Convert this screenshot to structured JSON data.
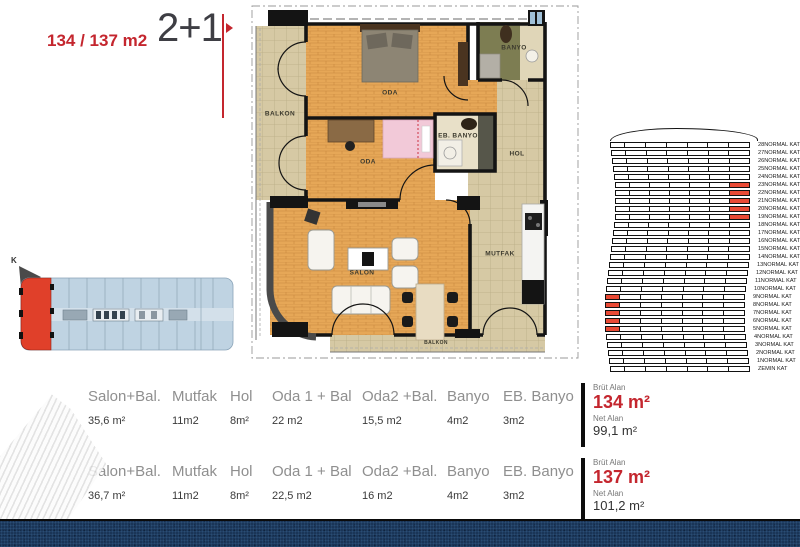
{
  "title": {
    "area_label": "134 / 137 m2",
    "type_label": "2+1"
  },
  "floor_plan": {
    "labels": {
      "balkon_left": "BALKON",
      "oda_top": "ODA",
      "banyo": "BANYO",
      "oda_mid": "ODA",
      "eb_banyo": "EB. BANYO",
      "hol": "HOL",
      "salon": "SALON",
      "mutfak": "MUTFAK",
      "balkon_bottom": "BALKON"
    }
  },
  "site_plan": {
    "north_label": "K"
  },
  "elevation": {
    "columns": 7,
    "highlight_color": "#e94a35",
    "floors": [
      "28NORMAL KAT",
      "27NORMAL KAT",
      "26NORMAL KAT",
      "25NORMAL KAT",
      "24NORMAL KAT",
      "23NORMAL KAT",
      "22NORMAL KAT",
      "21NORMAL KAT",
      "20NORMAL KAT",
      "19NORMAL KAT",
      "18NORMAL KAT",
      "17NORMAL KAT",
      "16NORMAL KAT",
      "15NORMAL KAT",
      "14NORMAL KAT",
      "13NORMAL KAT",
      "12NORMAL KAT",
      "11NORMAL KAT",
      "10NORMAL KAT",
      "9NORMAL KAT",
      "8NORMAL KAT",
      "7NORMAL KAT",
      "6NORMAL KAT",
      "5NORMAL KAT",
      "4NORMAL KAT",
      "3NORMAL KAT",
      "2NORMAL KAT",
      "1NORMAL KAT",
      "ZEMIN KAT"
    ],
    "highlights": [
      {
        "floor": "23NORMAL KAT",
        "col": 6
      },
      {
        "floor": "22NORMAL KAT",
        "col": 6
      },
      {
        "floor": "21NORMAL KAT",
        "col": 6
      },
      {
        "floor": "20NORMAL KAT",
        "col": 6
      },
      {
        "floor": "19NORMAL KAT",
        "col": 6
      },
      {
        "floor": "9NORMAL KAT",
        "col": 0
      },
      {
        "floor": "8NORMAL KAT",
        "col": 0
      },
      {
        "floor": "7NORMAL KAT",
        "col": 0
      },
      {
        "floor": "6NORMAL KAT",
        "col": 0
      },
      {
        "floor": "5NORMAL KAT",
        "col": 0
      }
    ]
  },
  "spec_tables": [
    {
      "columns": [
        {
          "header": "Salon+Bal.",
          "value": "35,6 m²"
        },
        {
          "header": "Mutfak",
          "value": "11m2"
        },
        {
          "header": "Hol",
          "value": "8m²"
        },
        {
          "header": "Oda 1 + Bal",
          "value": "22 m2"
        },
        {
          "header": "Oda2 +Bal.",
          "value": "15,5 m2"
        },
        {
          "header": "Banyo",
          "value": "4m2"
        },
        {
          "header": "EB. Banyo",
          "value": "3m2"
        }
      ],
      "brut_label": "Brüt Alan",
      "brut_value": "134 m²",
      "net_label": "Net Alan",
      "net_value": "99,1 m²"
    },
    {
      "columns": [
        {
          "header": "Salon+Bal.",
          "value": "36,7 m²"
        },
        {
          "header": "Mutfak",
          "value": "11m2"
        },
        {
          "header": "Hol",
          "value": "8m²"
        },
        {
          "header": "Oda 1 + Bal",
          "value": "22,5 m2"
        },
        {
          "header": "Oda2 +Bal.",
          "value": "16 m2"
        },
        {
          "header": "Banyo",
          "value": "4m2"
        },
        {
          "header": "EB. Banyo",
          "value": "3m2"
        }
      ],
      "brut_label": "Brüt Alan",
      "brut_value": "137 m²",
      "net_label": "Net Alan",
      "net_value": "101,2 m²"
    }
  ],
  "colors": {
    "accent_red": "#c4262e",
    "highlight_red": "#e94a35",
    "wood": "#e3a055",
    "tile": "#d4c7a2",
    "site_blue": "#bfd3e2",
    "footer_navy": "#1a3557"
  }
}
